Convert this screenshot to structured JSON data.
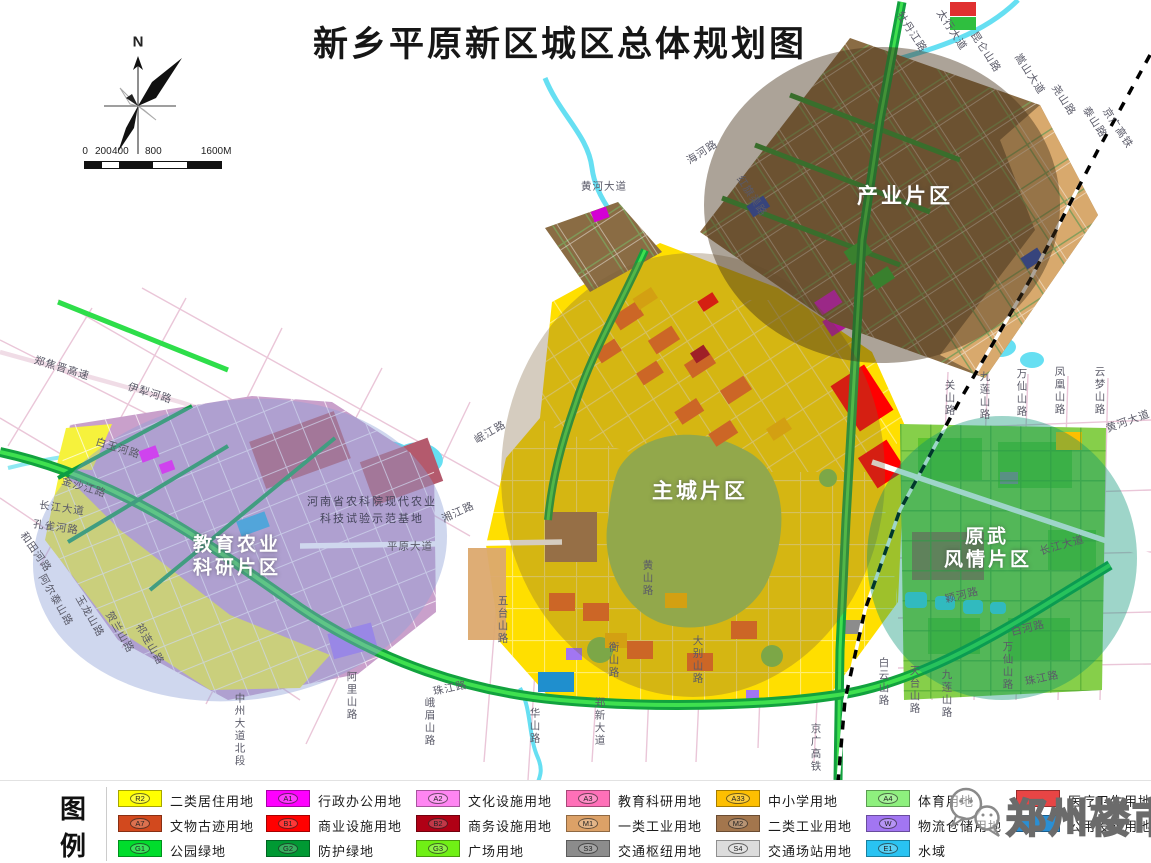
{
  "title": "新乡平原新区城区总体规划图",
  "compass": {
    "north_label": "N"
  },
  "scale_bar": {
    "ticks": [
      {
        "label": "0",
        "x": 0
      },
      {
        "label": "200",
        "x": 16
      },
      {
        "label": "400",
        "x": 33
      },
      {
        "label": "800",
        "x": 66
      },
      {
        "label": "1600M",
        "x": 126
      }
    ],
    "segments": [
      {
        "w": 17,
        "color": "#111111"
      },
      {
        "w": 17,
        "color": "#ffffff"
      },
      {
        "w": 34,
        "color": "#111111"
      },
      {
        "w": 34,
        "color": "#ffffff"
      },
      {
        "w": 34,
        "color": "#111111"
      }
    ]
  },
  "map_labels": {
    "district_labels": [
      {
        "text": "产业片区",
        "x": 905,
        "y": 195,
        "size": 21
      },
      {
        "text": "主城片区",
        "x": 700,
        "y": 490,
        "size": 21
      },
      {
        "text": "教育农业",
        "x": 237,
        "y": 543,
        "size": 19
      },
      {
        "text": "科研片区",
        "x": 237,
        "y": 566,
        "size": 19
      },
      {
        "text": "原武",
        "x": 987,
        "y": 535,
        "size": 19
      },
      {
        "text": "风情片区",
        "x": 988,
        "y": 558,
        "size": 19
      }
    ],
    "site_caption": {
      "lines": [
        {
          "text": "河南省农科院现代农业",
          "x": 372,
          "y": 501
        },
        {
          "text": "科技试验示范基地",
          "x": 372,
          "y": 518
        }
      ]
    },
    "road_labels": [
      {
        "t": "郑焦晋高速",
        "x": 62,
        "y": 368,
        "r": 17,
        "v": false
      },
      {
        "t": "伊犁河路",
        "x": 150,
        "y": 393,
        "r": 17,
        "v": false
      },
      {
        "t": "白玉河路",
        "x": 118,
        "y": 448,
        "r": 17,
        "v": false
      },
      {
        "t": "金沙江路",
        "x": 84,
        "y": 487,
        "r": 17,
        "v": false
      },
      {
        "t": "长江大道",
        "x": 62,
        "y": 508,
        "r": 8,
        "v": false
      },
      {
        "t": "孔雀河路",
        "x": 56,
        "y": 527,
        "r": 8,
        "v": false
      },
      {
        "t": "和田河路",
        "x": 36,
        "y": 552,
        "r": 55,
        "v": false
      },
      {
        "t": "阿尔泰山路",
        "x": 56,
        "y": 600,
        "r": 60,
        "v": false
      },
      {
        "t": "玉龙山路",
        "x": 90,
        "y": 616,
        "r": 60,
        "v": false
      },
      {
        "t": "贺兰山路",
        "x": 120,
        "y": 632,
        "r": 60,
        "v": false
      },
      {
        "t": "祁连山路",
        "x": 150,
        "y": 644,
        "r": 60,
        "v": false
      },
      {
        "t": "中州大道北段",
        "x": 240,
        "y": 730,
        "r": 0,
        "v": true
      },
      {
        "t": "阿里山路",
        "x": 352,
        "y": 696,
        "r": 0,
        "v": true
      },
      {
        "t": "峨眉山路",
        "x": 430,
        "y": 722,
        "r": 0,
        "v": true
      },
      {
        "t": "珠江路",
        "x": 450,
        "y": 688,
        "r": -12,
        "v": false
      },
      {
        "t": "华山路",
        "x": 535,
        "y": 726,
        "r": 0,
        "v": true
      },
      {
        "t": "郑新大道",
        "x": 600,
        "y": 722,
        "r": 0,
        "v": true
      },
      {
        "t": "五台山路",
        "x": 503,
        "y": 620,
        "r": 0,
        "v": true
      },
      {
        "t": "黄山路",
        "x": 648,
        "y": 578,
        "r": 0,
        "v": true
      },
      {
        "t": "衡山路",
        "x": 614,
        "y": 660,
        "r": 0,
        "v": true
      },
      {
        "t": "大别山路",
        "x": 698,
        "y": 660,
        "r": 0,
        "v": true
      },
      {
        "t": "白云山路",
        "x": 884,
        "y": 682,
        "r": 0,
        "v": true
      },
      {
        "t": "天台山路",
        "x": 915,
        "y": 690,
        "r": 0,
        "v": true
      },
      {
        "t": "九莲山路",
        "x": 947,
        "y": 694,
        "r": 0,
        "v": true
      },
      {
        "t": "万仙山路",
        "x": 1008,
        "y": 666,
        "r": 0,
        "v": true
      },
      {
        "t": "珠江路",
        "x": 1042,
        "y": 678,
        "r": -12,
        "v": false
      },
      {
        "t": "白河路",
        "x": 1028,
        "y": 628,
        "r": -14,
        "v": false
      },
      {
        "t": "颖河路",
        "x": 962,
        "y": 595,
        "r": -14,
        "v": false
      },
      {
        "t": "长江大道",
        "x": 1062,
        "y": 545,
        "r": -16,
        "v": false
      },
      {
        "t": "平原大道",
        "x": 410,
        "y": 546,
        "r": 0,
        "v": false
      },
      {
        "t": "湘江路",
        "x": 458,
        "y": 512,
        "r": -25,
        "v": false
      },
      {
        "t": "岷江路",
        "x": 490,
        "y": 432,
        "r": -30,
        "v": false
      },
      {
        "t": "黄河大道",
        "x": 604,
        "y": 186,
        "r": 0,
        "v": false
      },
      {
        "t": "海河路",
        "x": 702,
        "y": 152,
        "r": -33,
        "v": false
      },
      {
        "t": "红旗渠路",
        "x": 752,
        "y": 196,
        "r": 57,
        "v": false
      },
      {
        "t": "牡丹江路",
        "x": 912,
        "y": 32,
        "r": 57,
        "v": false
      },
      {
        "t": "太行大道",
        "x": 952,
        "y": 30,
        "r": 57,
        "v": false
      },
      {
        "t": "昆仑山路",
        "x": 986,
        "y": 52,
        "r": 57,
        "v": false
      },
      {
        "t": "嵩山大道",
        "x": 1030,
        "y": 74,
        "r": 57,
        "v": false
      },
      {
        "t": "尧山路",
        "x": 1064,
        "y": 100,
        "r": 57,
        "v": false
      },
      {
        "t": "泰山路",
        "x": 1095,
        "y": 122,
        "r": 57,
        "v": false
      },
      {
        "t": "京广高铁",
        "x": 1118,
        "y": 128,
        "r": 57,
        "v": false
      },
      {
        "t": "京广高铁",
        "x": 816,
        "y": 748,
        "r": 0,
        "v": true
      },
      {
        "t": "关山路",
        "x": 950,
        "y": 398,
        "r": 0,
        "v": true
      },
      {
        "t": "九莲山路",
        "x": 985,
        "y": 396,
        "r": 0,
        "v": true
      },
      {
        "t": "万仙山路",
        "x": 1022,
        "y": 393,
        "r": 0,
        "v": true
      },
      {
        "t": "凤凰山路",
        "x": 1060,
        "y": 391,
        "r": 0,
        "v": true
      },
      {
        "t": "云梦山路",
        "x": 1100,
        "y": 391,
        "r": 0,
        "v": true
      },
      {
        "t": "黄河大道",
        "x": 1128,
        "y": 421,
        "r": -20,
        "v": false
      }
    ]
  },
  "legend": {
    "header_chars": [
      "图",
      "例"
    ],
    "columns_x": [
      118,
      266,
      416,
      566,
      716,
      866,
      1016
    ],
    "rows_y": [
      9,
      34,
      59
    ],
    "items": [
      {
        "col": 0,
        "row": 0,
        "code": "R2",
        "color": "#ffff00",
        "label": "二类居住用地"
      },
      {
        "col": 0,
        "row": 1,
        "code": "A7",
        "color": "#d2491e",
        "label": "文物古迹用地"
      },
      {
        "col": 0,
        "row": 2,
        "code": "G1",
        "color": "#00dd2c",
        "label": "公园绿地"
      },
      {
        "col": 1,
        "row": 0,
        "code": "A1",
        "color": "#ff00ff",
        "label": "行政办公用地"
      },
      {
        "col": 1,
        "row": 1,
        "code": "B1",
        "color": "#ff0000",
        "label": "商业设施用地"
      },
      {
        "col": 1,
        "row": 2,
        "code": "G2",
        "color": "#009933",
        "label": "防护绿地"
      },
      {
        "col": 2,
        "row": 0,
        "code": "A2",
        "color": "#ff85f2",
        "label": "文化设施用地"
      },
      {
        "col": 2,
        "row": 1,
        "code": "B2",
        "color": "#b00015",
        "label": "商务设施用地"
      },
      {
        "col": 2,
        "row": 2,
        "code": "G3",
        "color": "#70f015",
        "label": "广场用地"
      },
      {
        "col": 3,
        "row": 0,
        "code": "A3",
        "color": "#ff70b8",
        "label": "教育科研用地"
      },
      {
        "col": 3,
        "row": 1,
        "code": "M1",
        "color": "#dca167",
        "label": "一类工业用地"
      },
      {
        "col": 3,
        "row": 2,
        "code": "S3",
        "color": "#8c8c8c",
        "label": "交通枢纽用地"
      },
      {
        "col": 4,
        "row": 0,
        "code": "A33",
        "color": "#fdbf01",
        "label": "中小学用地"
      },
      {
        "col": 4,
        "row": 1,
        "code": "M2",
        "color": "#a3764d",
        "label": "二类工业用地"
      },
      {
        "col": 4,
        "row": 2,
        "code": "S4",
        "color": "#dcdcdc",
        "label": "交通场站用地"
      },
      {
        "col": 5,
        "row": 0,
        "code": "A4",
        "color": "#8ef07e",
        "label": "体育用地"
      },
      {
        "col": 5,
        "row": 1,
        "code": "W",
        "color": "#a276f2",
        "label": "物流仓储用地"
      },
      {
        "col": 5,
        "row": 2,
        "code": "E1",
        "color": "#29c3f2",
        "label": "水域"
      },
      {
        "col": 6,
        "row": 0,
        "code": "",
        "color": "#e84545",
        "label": "医疗卫生用地"
      },
      {
        "col": 6,
        "row": 1,
        "code": "",
        "color": "#2a8fd4",
        "label": "公用设施用地"
      }
    ]
  },
  "watermark": {
    "text": "郑州楼市"
  }
}
